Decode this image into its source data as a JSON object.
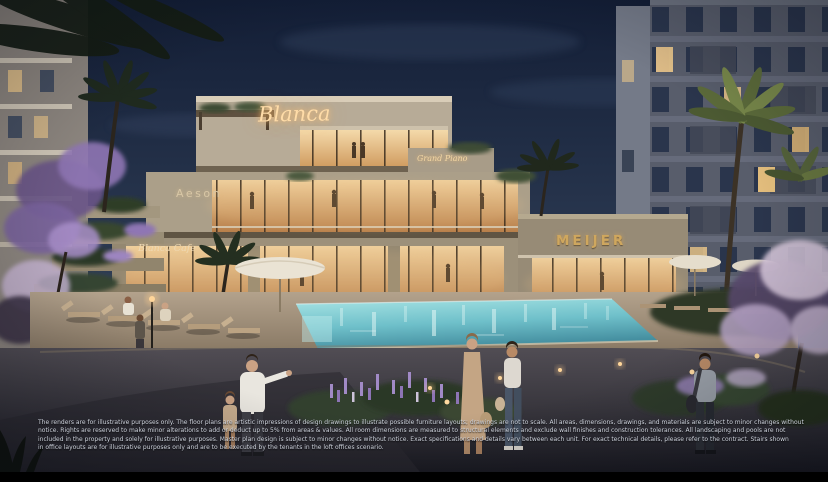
{
  "signs": {
    "blanca": "Blanca",
    "grand_piano": "Grand Piano",
    "aeson": "Aeson",
    "blanca_cafe": "Blanca Cafe",
    "meijer": "MEIJER"
  },
  "disclaimer": {
    "lines": [
      "The renders are for illustrative purposes only. The floor plans are artistic impressions of design drawings to illustrate possible furniture layouts; drawings are not to scale. All areas, dimensions, drawings, and materials are subject to minor changes without",
      "notice. Rights are reserved to make minor alterations to add or deduct up to 5% from areas & values. All room dimensions are measured to structural elements and exclude wall finishes and construction tolerances. All landscaping and pools are not",
      "included in the property and solely for illustrative purposes. Master plan design is subject to minor changes without notice. Exact specifications and details vary between each unit. For exact technical details, please refer to the contract. Stairs shown",
      "in office layouts are for illustrative purposes only and are to be executed by the tenants in the loft offices scenario."
    ]
  },
  "colors": {
    "sky_top": "#131e36",
    "sky_horizon": "#6e7890",
    "sign_gold": "#ffdca8",
    "warm_glass": "#f6ddae",
    "pool_turquoise": "#8fd8dc",
    "stone_deck": "#b3a28c",
    "plaza_dark": "#1a1a20",
    "foliage_purple": "#9b7fc4"
  }
}
